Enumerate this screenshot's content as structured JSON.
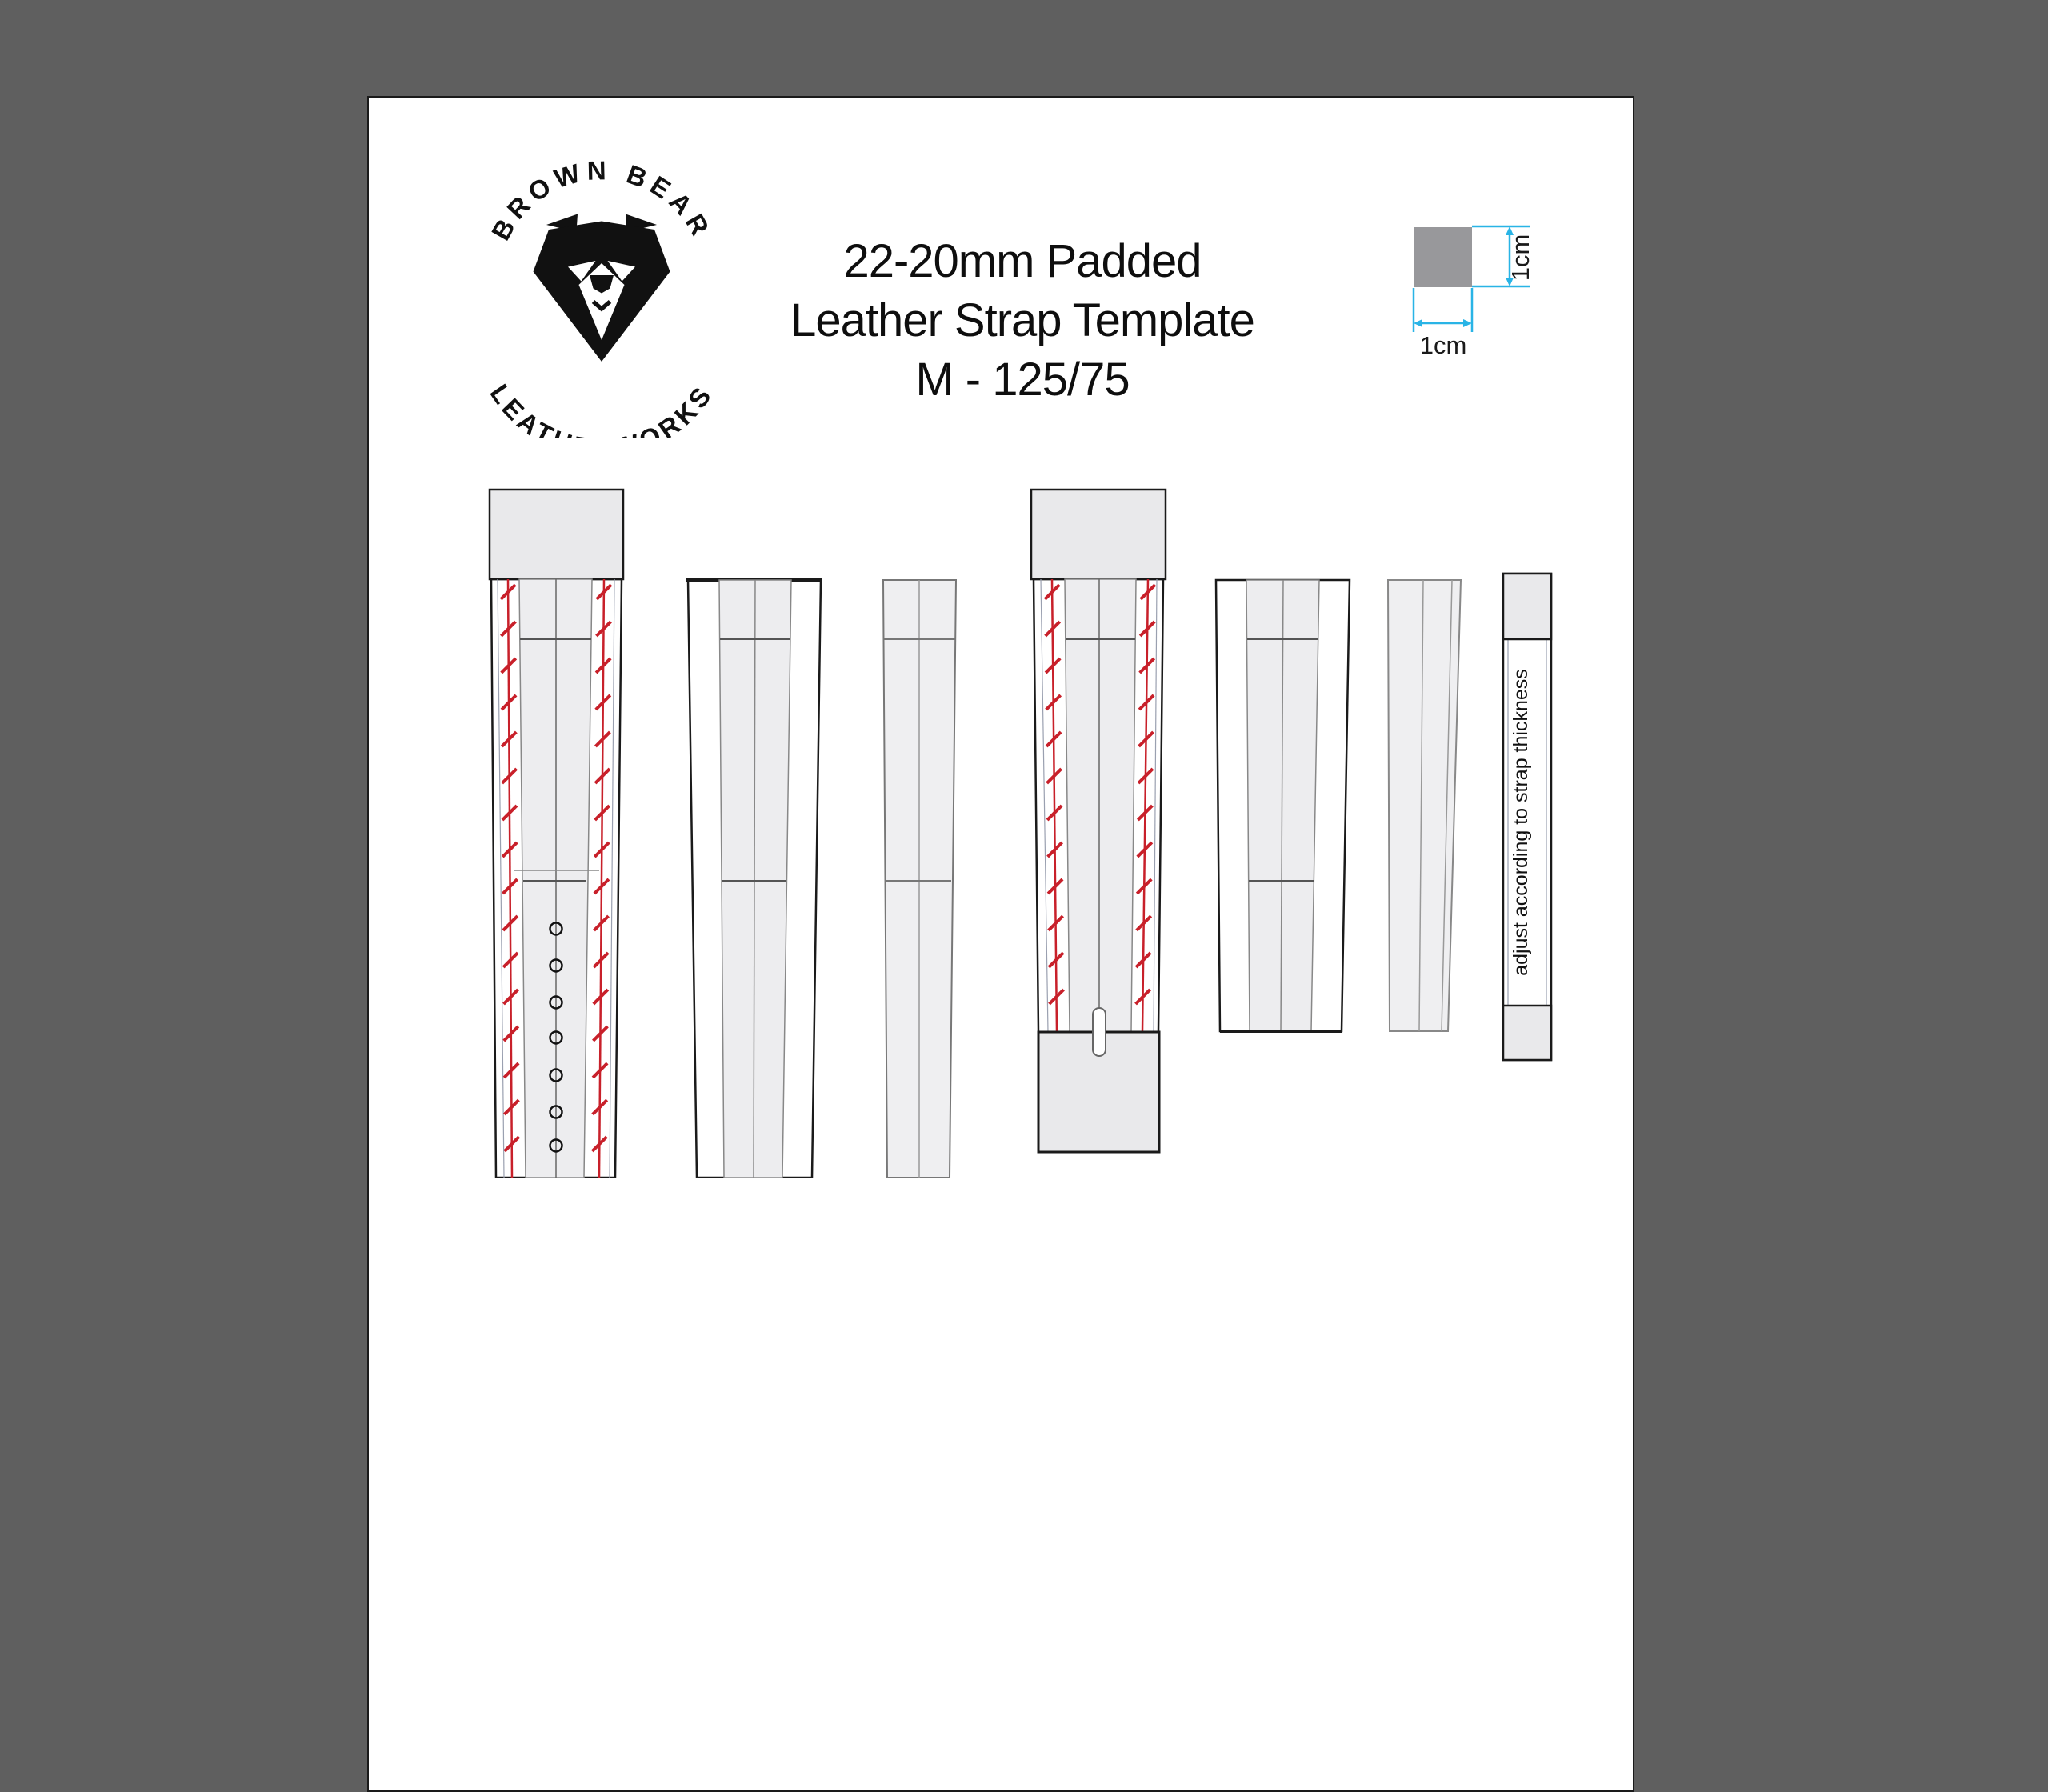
{
  "window": {
    "background_color": "#5f5f5f"
  },
  "page": {
    "background_color": "#ffffff",
    "border_color": "#1a1a1a"
  },
  "logo": {
    "arc_top_text": "BROWN BEAR",
    "arc_bottom_text": "LEATHERWORKS",
    "icon": "bear-head"
  },
  "title": {
    "line1": "22-20mm Padded",
    "line2": "Leather Strap Template",
    "line3": "M - 125/75"
  },
  "scale_reference": {
    "horizontal_label": "1cm",
    "vertical_label": "1cm",
    "square_color": "#98989b",
    "dimension_color": "#29b4e6"
  },
  "keeper_note": "adjust according to strap thickness",
  "template_pieces": [
    {
      "name": "main strap top layer",
      "features": "fold-over tab, red stitch lines, center line, 7 adjustment holes"
    },
    {
      "name": "main strap padding layer",
      "features": "tapered outline with center panel"
    },
    {
      "name": "main strap filler",
      "features": "narrow tapered piece with center line"
    },
    {
      "name": "buckle strap top layer",
      "features": "fold-over tab, red stitch lines, buckle-tongue slot, fold-under tab"
    },
    {
      "name": "buckle strap padding layer",
      "features": "tapered outline with center panel"
    },
    {
      "name": "buckle strap filler",
      "features": "narrow tapered piece"
    },
    {
      "name": "keeper loop",
      "features": "gray ends, note text rotated vertically"
    }
  ],
  "colors": {
    "stitch_red": "#c8202a",
    "tab_gray": "#e9e9eb",
    "panel_gray": "#ededef",
    "outline_black": "#1a1a1a",
    "outline_gray": "#888888",
    "thin_guide": "#9aa0b0"
  }
}
